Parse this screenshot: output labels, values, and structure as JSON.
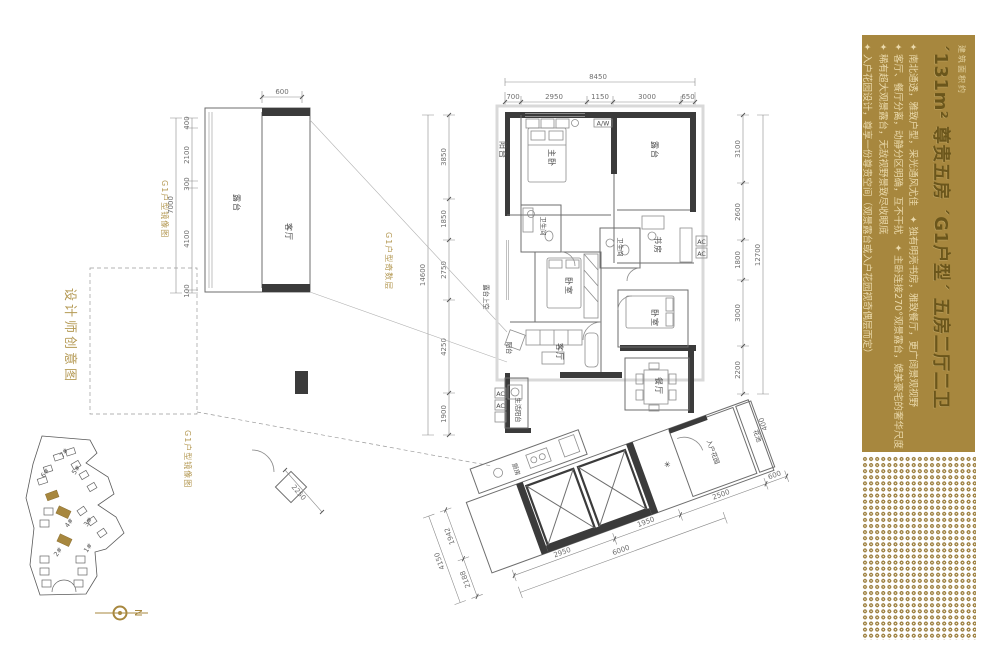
{
  "colors": {
    "accent_gold": "#a7873e",
    "dot_gold": "#9a7d3d",
    "gold_label": "#b59a55"
  },
  "right_panel": {
    "eyebrow": "建筑面积约",
    "title": "´131m² 尊贵五房 ´G1户型´ 五房二厅二卫",
    "bullets": [
      "✦ 南北通透，雅致户型，采光通风尤佳　✦ 独有明亮书房，雅致餐厅，更广阔景观视野",
      "✦ 客厅、餐厅分离，动静分区明确，互不干扰　✦ 主卧连接270°观景露台，媲美豪宅的奢华尺度",
      "✦ 稀有超大观景露台，无敌视野景致尽收眼底",
      "✦ 入户花园设计，尊享一份尊贵空间（观景露台或入户花园视奇偶层而定）"
    ]
  },
  "left_caption": "设计师创意图",
  "plan": {
    "unit_labels": {
      "mirror_left": "G1户型镜像图",
      "odd_center": "G1户型奇数层",
      "mirror_bottom": "G1户型镜像图"
    },
    "rooms": {
      "balcony": "阳台",
      "master": "主卧",
      "terrace": "露台",
      "aw": "A/W",
      "bath": "卫生间",
      "study": "书房",
      "bed": "卧室",
      "terrace_void": "露台上空",
      "living": "客厅",
      "dining": "餐厅",
      "service_balcony": "生活阳台",
      "ac": "AC",
      "kitchen": "厨房",
      "entry_garden": "入户花园",
      "flower_bed": "花池"
    },
    "dims": {
      "top_total": "8450",
      "top": [
        "700",
        "2950",
        "1150",
        "3000",
        "650"
      ],
      "left_total": "14600",
      "left": [
        "3850",
        "1850",
        "2750",
        "4250",
        "1900"
      ],
      "right_total": "12700",
      "right": [
        "3100",
        "2600",
        "1800",
        "3000",
        "2200"
      ],
      "sub_top": "600",
      "sub_left_total": "7000",
      "sub_left": [
        "400",
        "2100",
        "300",
        "4100",
        "100"
      ],
      "bottom": [
        "2950",
        "1950",
        "6000",
        "2500",
        "600",
        "400",
        "1942",
        "2188",
        "4150",
        "2250"
      ]
    }
  },
  "site_plan": {
    "buildings": [
      "1#",
      "2#",
      "3#",
      "4#",
      "5#",
      "6#",
      "7#"
    ],
    "compass": "N"
  }
}
